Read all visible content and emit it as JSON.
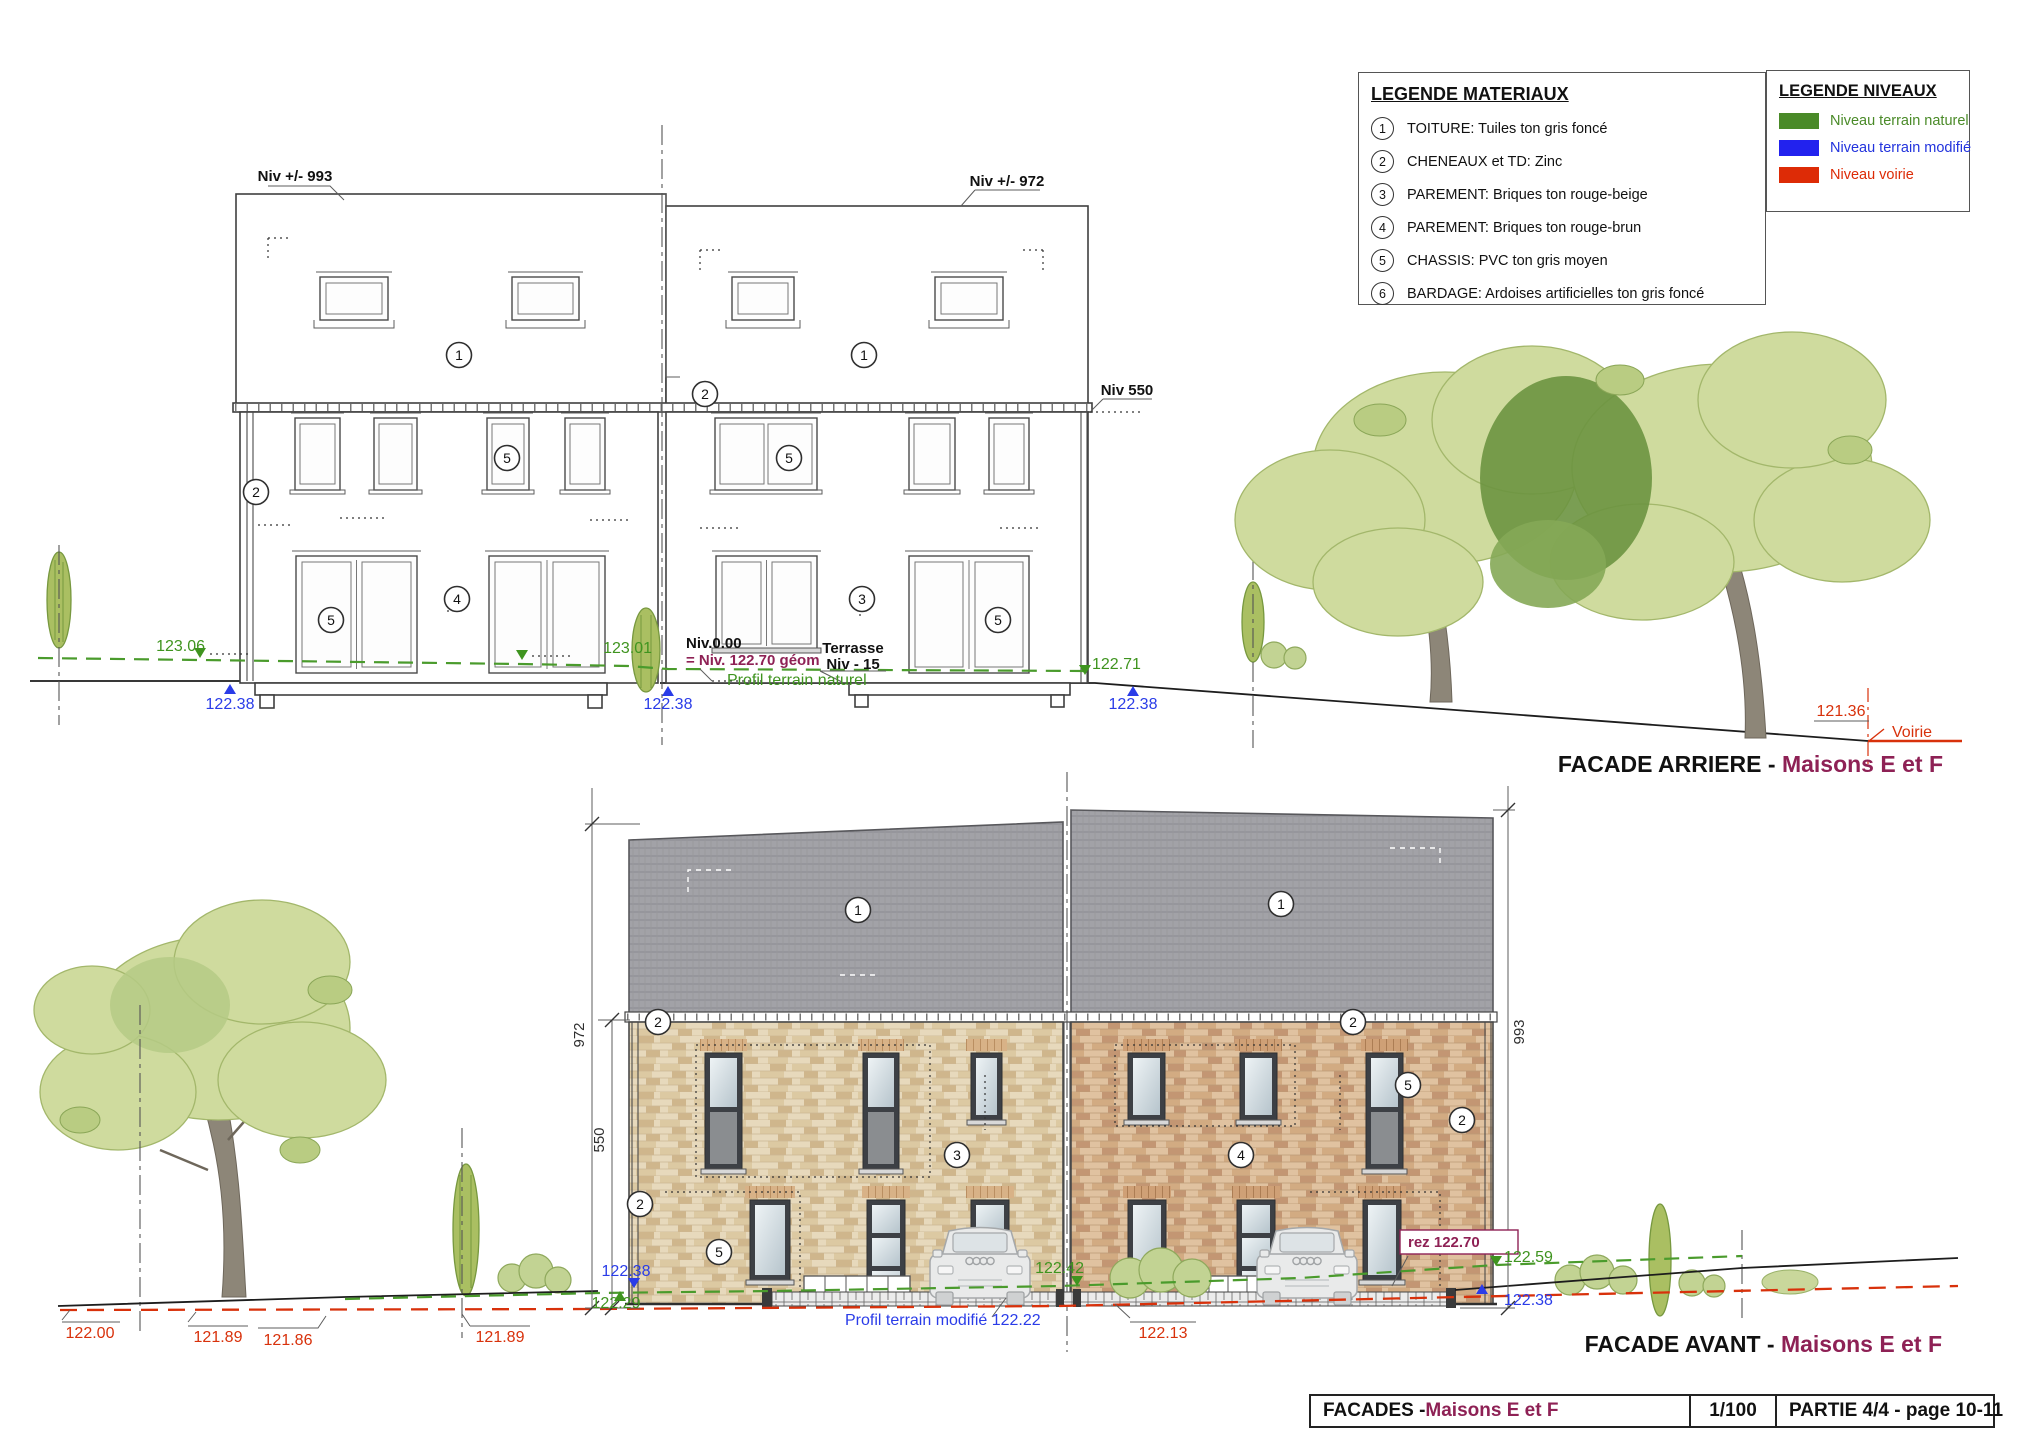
{
  "legend_materiaux": {
    "title": "LEGENDE MATERIAUX",
    "items": [
      {
        "num": "1",
        "text": "TOITURE: Tuiles ton gris foncé"
      },
      {
        "num": "2",
        "text": "CHENEAUX et TD: Zinc"
      },
      {
        "num": "3",
        "text": "PAREMENT: Briques ton rouge-beige"
      },
      {
        "num": "4",
        "text": "PAREMENT: Briques ton rouge-brun"
      },
      {
        "num": "5",
        "text": "CHASSIS: PVC ton gris moyen"
      },
      {
        "num": "6",
        "text": "BARDAGE: Ardoises artificielles ton gris foncé"
      }
    ]
  },
  "legend_niveaux": {
    "title": "LEGENDE NIVEAUX",
    "items": [
      {
        "label": "Niveau terrain naturel",
        "color": "#4a8a28"
      },
      {
        "label": "Niveau terrain modifié",
        "color": "#2222ee"
      },
      {
        "label": "Niveau voirie",
        "color": "#dd2b06"
      }
    ]
  },
  "arriere": {
    "caption_prefix": "FACADE ARRIERE - ",
    "caption_name": "Maisons E et F",
    "labels": {
      "niv993": "Niv +/- 993",
      "niv972": "Niv +/- 972",
      "niv550": "Niv 550",
      "niv000": "Niv.0.00",
      "geom": "= Niv. 122.70 géom",
      "profil": "Profil terrain naturel",
      "terrasse1": "Terrasse",
      "terrasse2": "Niv - 15",
      "voirie": "Voirie"
    },
    "elev": {
      "g1": "123.06",
      "b1": "122.38",
      "g2": "123.01",
      "b2": "122.38",
      "g3": "122.71",
      "b3": "122.38",
      "road": "121.36"
    },
    "markers": [
      "1",
      "1",
      "2",
      "2",
      "5",
      "5",
      "5",
      "4",
      "3",
      "5"
    ]
  },
  "avant": {
    "caption_prefix": "FACADE AVANT - ",
    "caption_name": "Maisons E et F",
    "dims": {
      "total_left": "972",
      "gutter_left": "550",
      "total_right": "993"
    },
    "labels": {
      "rez": "rez 122.70",
      "profil": "Profil terrain modifié 122.22"
    },
    "elev": {
      "b1": "122.38",
      "g1": "122.29",
      "g2": "122.42",
      "r1": "122.13",
      "g3": "122.59",
      "b2": "122.38",
      "road": [
        "122.00",
        "121.89",
        "121.86",
        "121.89"
      ]
    },
    "markers": [
      "1",
      "1",
      "2",
      "2",
      "2",
      "2",
      "5",
      "3",
      "4",
      "5"
    ]
  },
  "title_block": {
    "title_prefix": "FACADES - ",
    "title_name": "Maisons E et F",
    "scale": "1/100",
    "part": "PARTIE 4/4 - page 10-11"
  },
  "colors": {
    "terrain_naturel": "#3f941f",
    "terrain_modifie": "#2a3ce8",
    "voirie": "#d8310b",
    "accent_maroon": "#8e2155",
    "roof_gray": "#a2a2a7",
    "brick_beige": "#e7d9bc",
    "brick_brun": "#e0c2a0"
  }
}
